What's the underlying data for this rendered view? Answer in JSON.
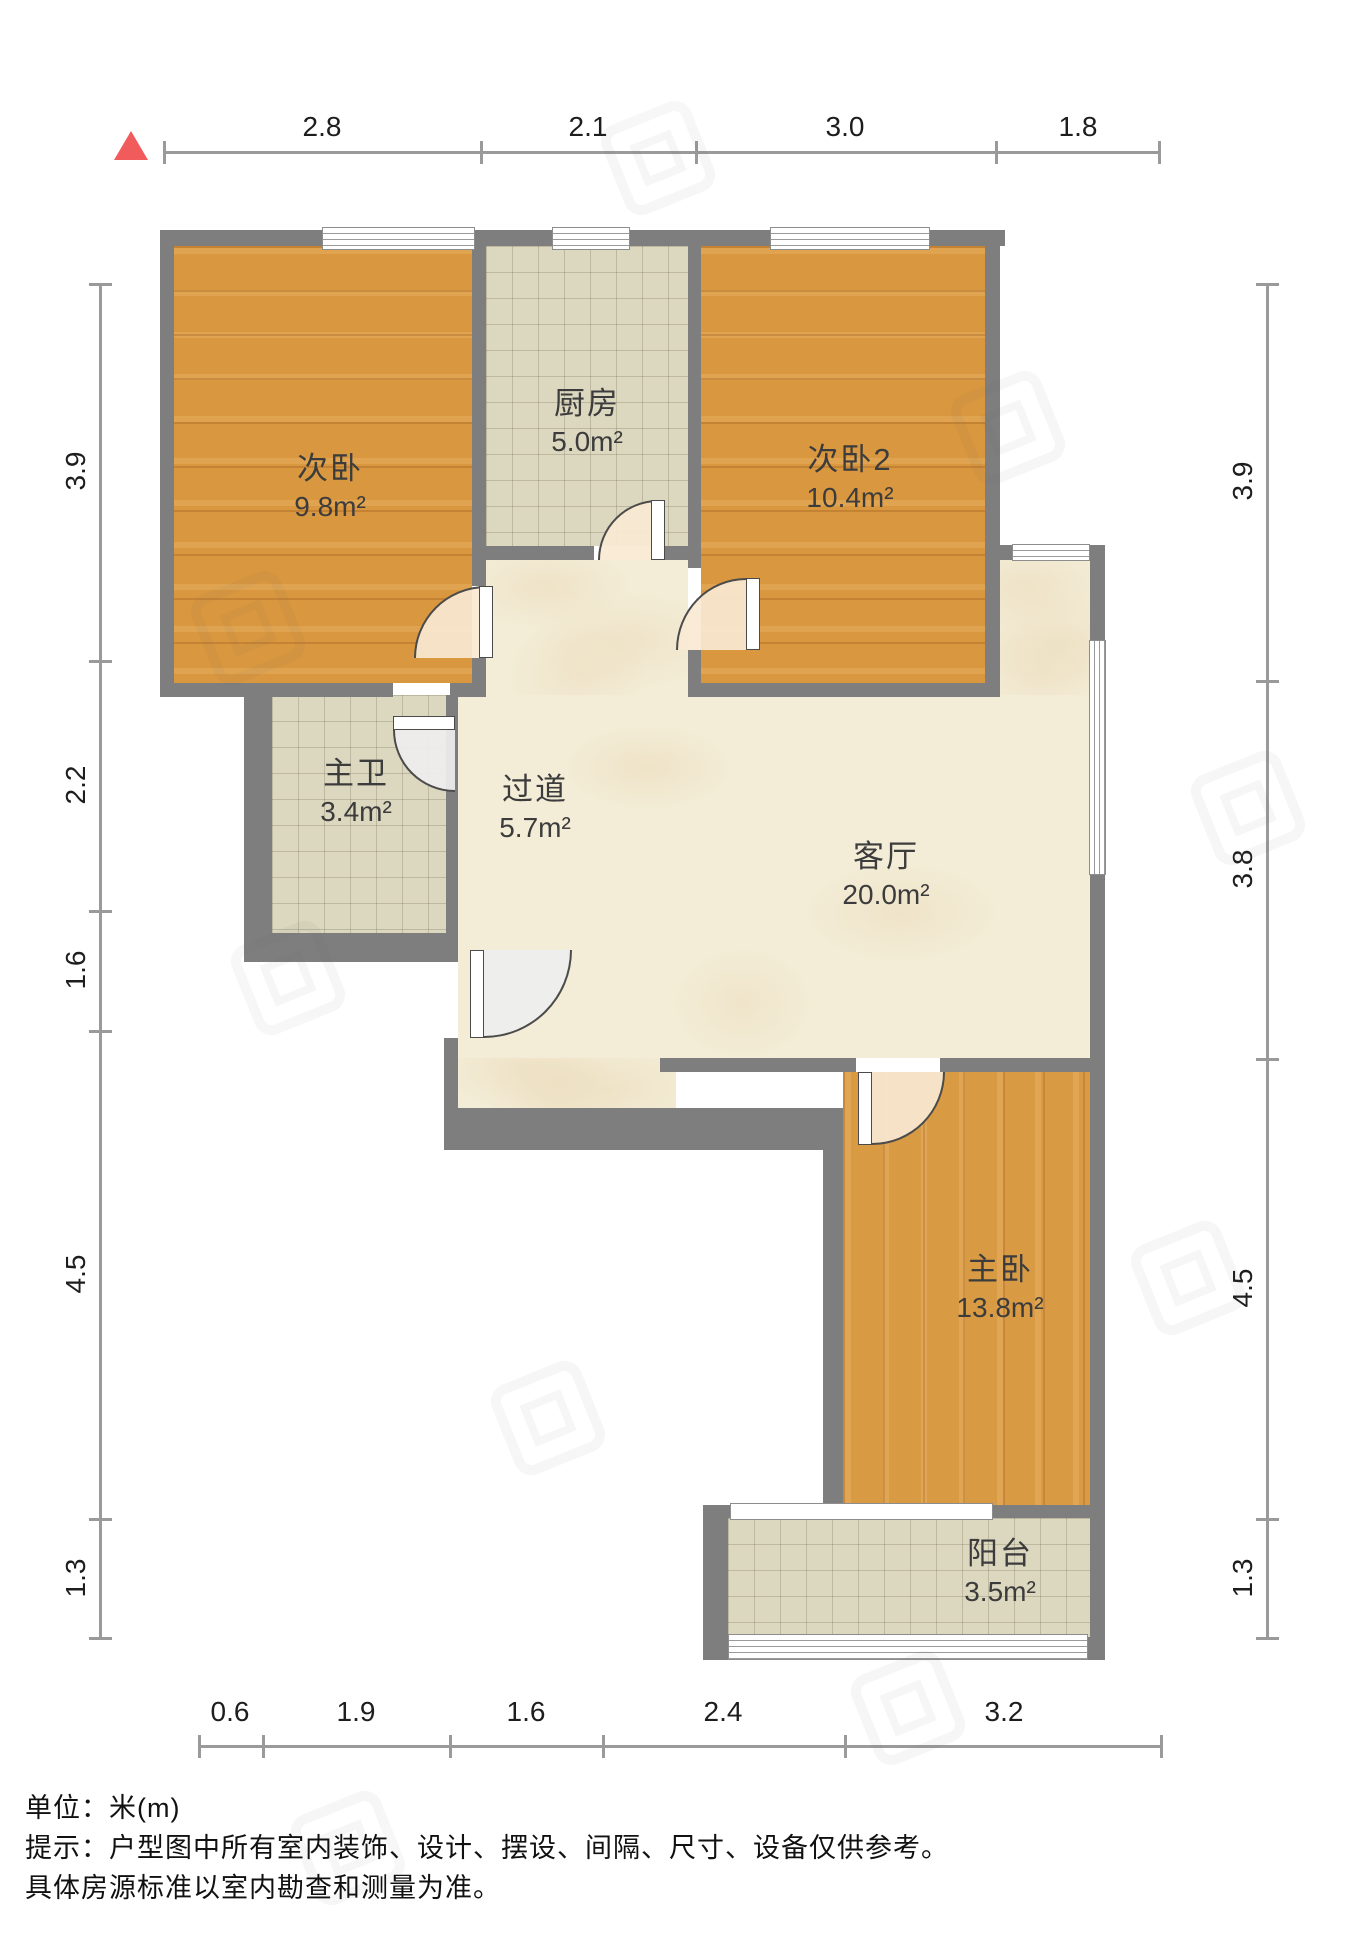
{
  "rooms": [
    {
      "id": "bedroom2",
      "name": "次卧",
      "area": "9.8m²"
    },
    {
      "id": "kitchen",
      "name": "厨房",
      "area": "5.0m²"
    },
    {
      "id": "bedroom3",
      "name": "次卧2",
      "area": "10.4m²"
    },
    {
      "id": "bathroom",
      "name": "主卫",
      "area": "3.4m²"
    },
    {
      "id": "hallway",
      "name": "过道",
      "area": "5.7m²"
    },
    {
      "id": "living",
      "name": "客厅",
      "area": "20.0m²"
    },
    {
      "id": "master",
      "name": "主卧",
      "area": "13.8m²"
    },
    {
      "id": "balcony",
      "name": "阳台",
      "area": "3.5m²"
    }
  ],
  "dimensions": {
    "unit": "m",
    "top": [
      "2.8",
      "2.1",
      "3.0",
      "1.8"
    ],
    "bottom": [
      "0.6",
      "1.9",
      "1.6",
      "2.4",
      "3.2"
    ],
    "left": [
      "3.9",
      "2.2",
      "1.6",
      "4.5",
      "1.3"
    ],
    "right": [
      "3.9",
      "3.8",
      "4.5",
      "1.3"
    ]
  },
  "footer": {
    "unit_label": "单位：米(m)",
    "note_line1": "提示：户型图中所有室内装饰、设计、摆设、间隔、尺寸、设备仅供参考。",
    "note_line2": "具体房源标准以室内勘查和测量为准。"
  },
  "colors": {
    "wall": "#7e7e7e",
    "wood_floor": "#d9973f",
    "tile_floor": "#dcd7bf",
    "marble_floor": "#f3ecd6",
    "north_arrow": "#f15b5b",
    "dimension_line": "#9a9a9a"
  }
}
